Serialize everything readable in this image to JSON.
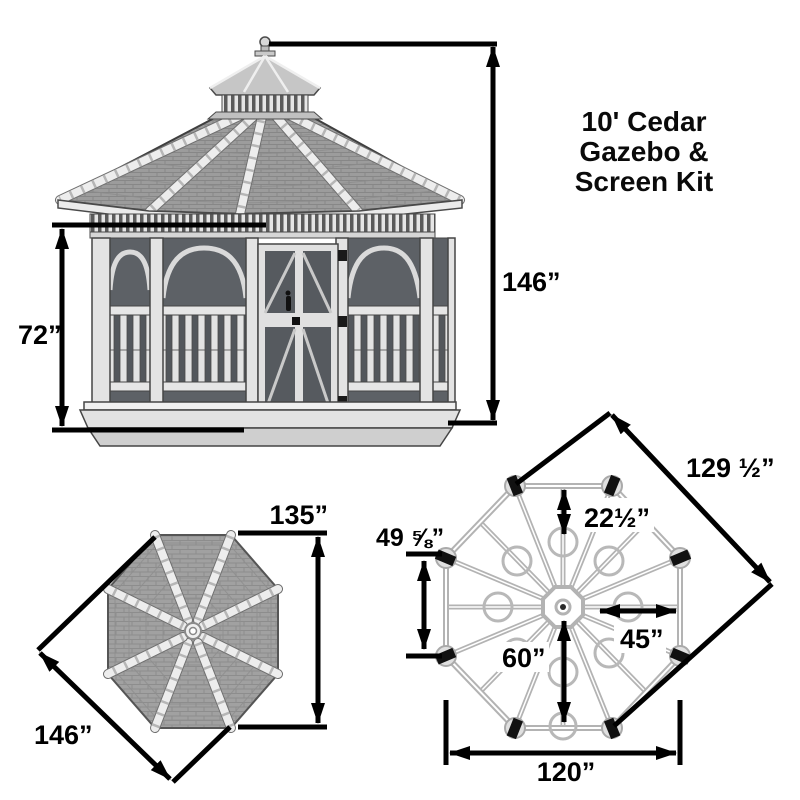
{
  "title": {
    "lines": [
      "10' Cedar",
      "Gazebo &",
      "Screen Kit"
    ]
  },
  "elevation": {
    "overall_height": "146”",
    "screen_height": "72”"
  },
  "roof_plan": {
    "flat_width": "135”",
    "corner_width": "146”"
  },
  "floor_plan": {
    "corner_to_corner": "129 ½”",
    "edge_to_pier": "22½”",
    "side_length": "49 ⅝”",
    "center_to_edge_horizontal": "45”",
    "center_to_edge_vertical": "60”",
    "flat_width": "120”"
  },
  "colors": {
    "dimension_line": "#000000",
    "shingle": "#9e9e9e",
    "trim": "#ebebeb",
    "screen": "#5d6166",
    "plan_frame": "#b3b3b3"
  }
}
